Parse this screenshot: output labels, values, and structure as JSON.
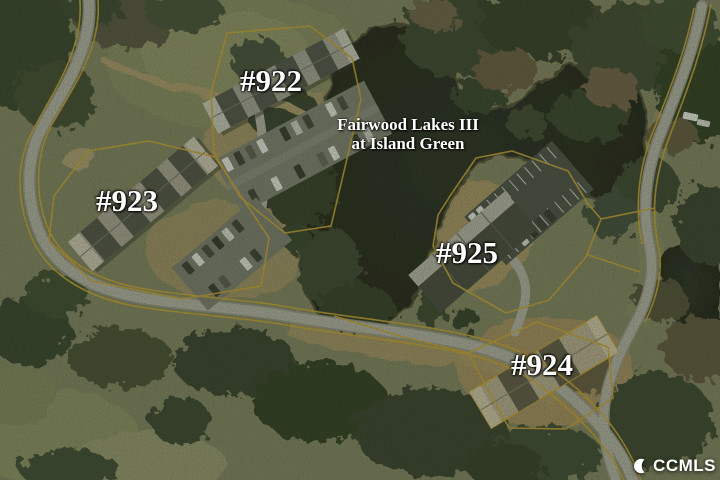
{
  "map": {
    "title": {
      "line1": "Fairwood Lakes III",
      "line2": "at Island Green"
    },
    "buildings": {
      "b922": {
        "label": "#922"
      },
      "b923": {
        "label": "#923"
      },
      "b924": {
        "label": "#924"
      },
      "b925": {
        "label": "#925"
      }
    }
  },
  "watermark": {
    "text": "CCMLS",
    "logo_icon": "crescent-c-icon"
  },
  "colors": {
    "parcel_boundary": "#c9a22b",
    "label_text": "#ffffff",
    "lake_water": "#12170e",
    "road_surface": "#aeaea2",
    "watermark_text": "#ffffff"
  }
}
